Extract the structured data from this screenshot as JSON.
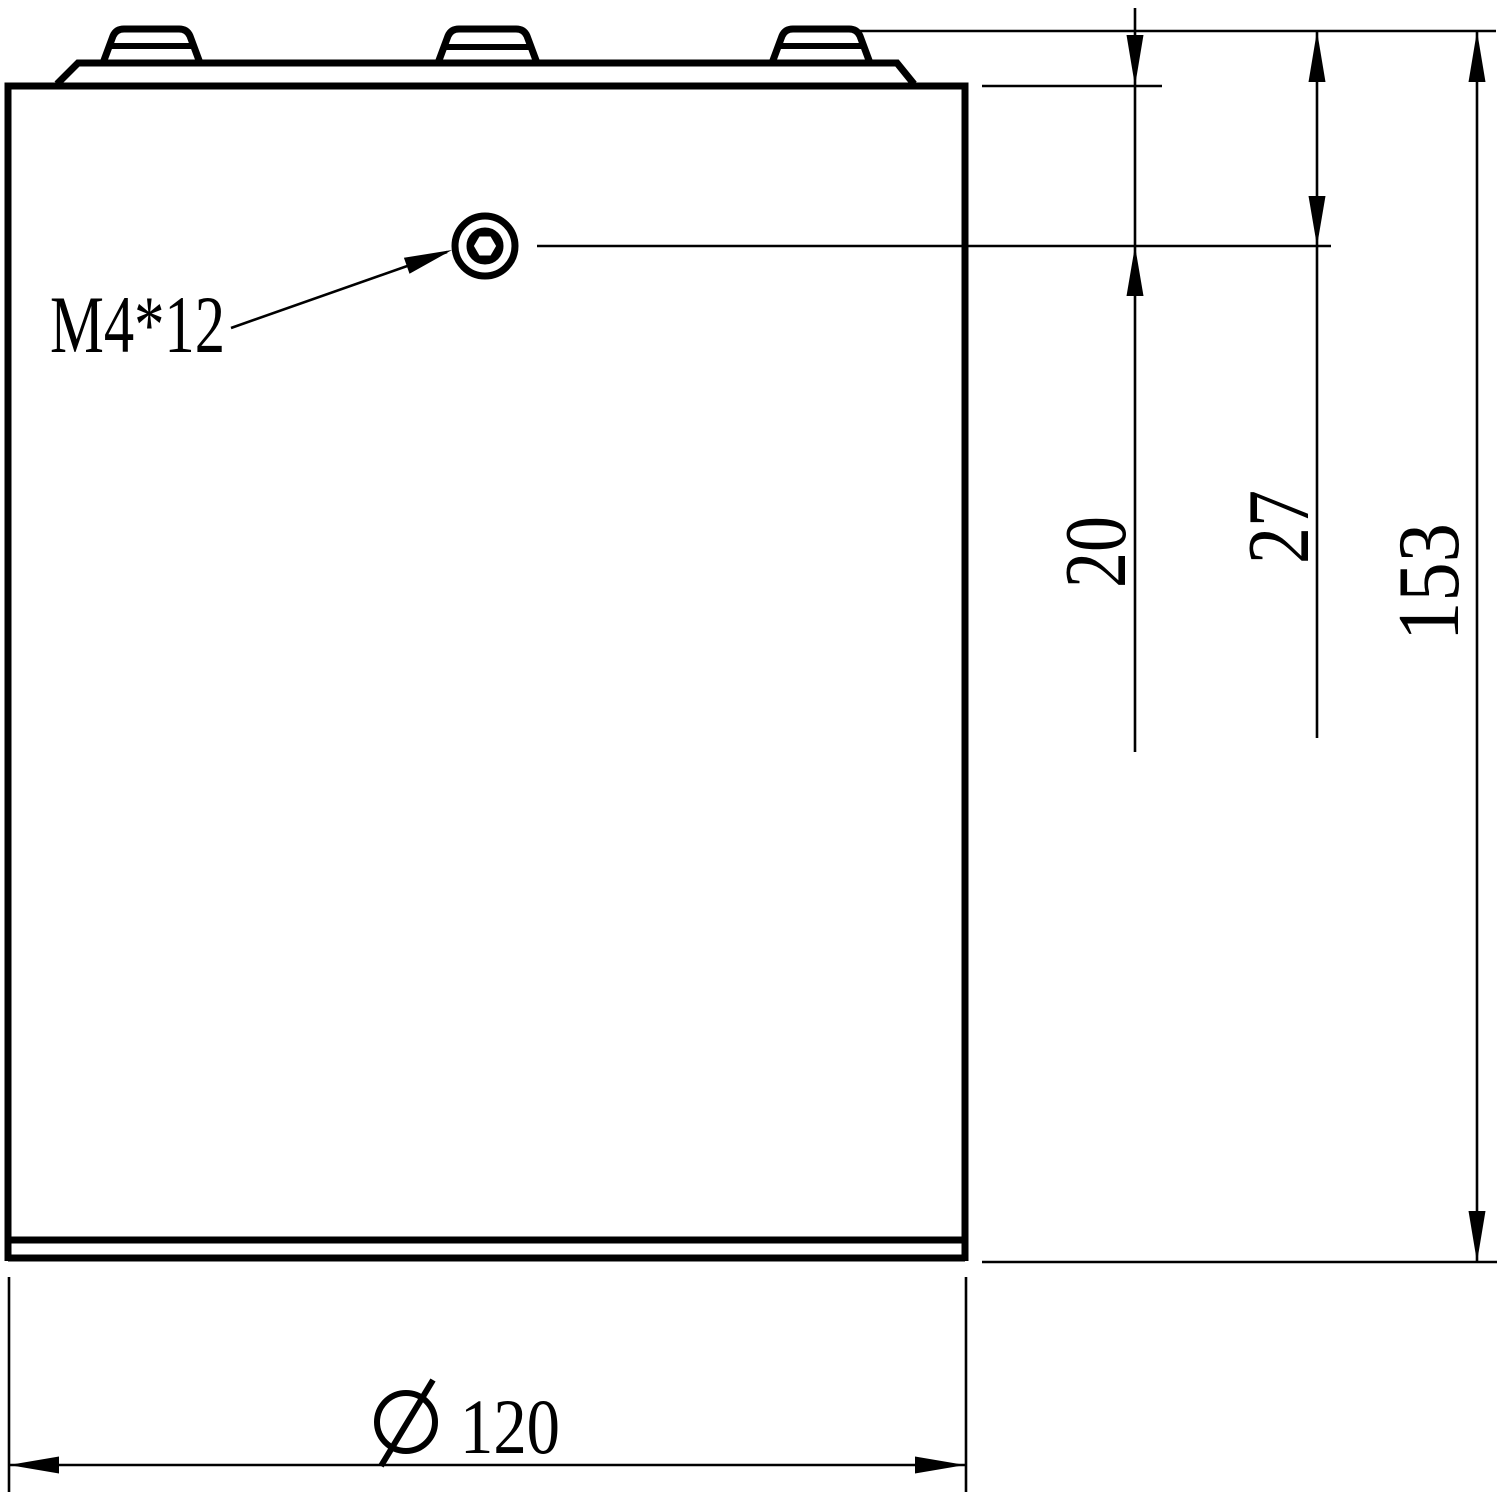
{
  "figure": {
    "kind": "mechanical engineering drawing - cylindrical cell side view with top terminals",
    "paper_color": "#ffffff",
    "ink_color": "#000000",
    "callout": {
      "screw_thread": "M4*12"
    },
    "dimensions": {
      "case_top_to_screw_center": "20",
      "terminal_top_to_screw_center": "27",
      "overall_height": "153",
      "diameter_value": "120",
      "diameter_label": "∅ 120"
    }
  }
}
